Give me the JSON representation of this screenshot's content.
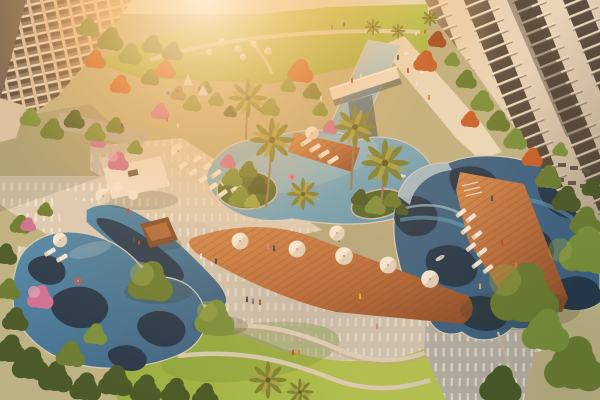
{
  "meta": {
    "title": "Resort-style residential courtyard — aerial render",
    "description": "Aerial architectural rendering at sunset: free-form lagoon pools with navy wave patterns, lap pool with white bridge, sun decks with white umbrellas and loungers, cabana, palm trees, lawns and apartment towers. Strong sun glare from the upper left."
  },
  "scene": {
    "lighting": "low warm sun, heavy glare upper-left, orange wash over scene",
    "buildings": {
      "left": "mid-rise apartment block with stacked white balconies",
      "right": "two high-rise towers, cream piers with dark glass and balcony slabs"
    },
    "water_features": [
      "lap pool with white bridge",
      "central lagoon pool with planted islands",
      "wave-pattern pool with in-water loungers",
      "free-form lagoon pool under trees"
    ],
    "amenities": [
      "dining deck with six white umbrellas",
      "white cabana",
      "brown pavilion",
      "lounger decks",
      "lawn terraces with curved curbs",
      "kids teepees and playground",
      "in-pool loungers"
    ],
    "vegetation": [
      "palm clusters",
      "autumn-orange trees",
      "pink bougainvillea",
      "tropical border planting",
      "large olive-green trees"
    ],
    "people": "about thirty small figures walking, dining, lounging and swimming"
  },
  "palette": {
    "glare_core": "#fff6e0",
    "glare_warm": "#ffd596",
    "warm_wash": "#ffb260",
    "lawn_light": "#b9cb55",
    "lawn_mid": "#8fb040",
    "lawn_dark": "#6d9634",
    "tree_dark": "#3c5526",
    "tree_olive": "#5f7a30",
    "tree_green": "#6f8f3a",
    "tree_light": "#96a848",
    "tree_autumn": "#c25a28",
    "tree_autumn_dark": "#9c4420",
    "tree_pink": "#cc6d9d",
    "tree_pink_light": "#e09cc0",
    "palm_frond": "#758032",
    "palm_frond_light": "#a3a348",
    "palm_trunk": "#9a7a52",
    "pool_pale": "#bcd8e4",
    "pool_light": "#7fb6d2",
    "pool_mid": "#4289b4",
    "pool_deep": "#2e5d87",
    "pool_navy": "#15304c",
    "pool_teal": "#57a0c0",
    "deck_wood": "#b5693c",
    "deck_wood_dark": "#8a4a28",
    "deck_warm": "#d08a50",
    "pave_light": "#d9d2c2",
    "pave_cool": "#b3b2ac",
    "pave_white": "#f3f0e8",
    "path_cream": "#e8dfc8",
    "bldg_wall": "#7b7066",
    "bldg_wall_dark": "#665c52",
    "bldg_cream": "#d6c7b2",
    "bldg_slab": "#eae3d5",
    "bldg_glass": "#46403a",
    "tower_cream": "#e7dbc6",
    "tower_glass": "#4a443f",
    "tower_slab": "#f0e6d4",
    "white": "#f5f0e4",
    "umbrella_shadow": "#d9d0bd",
    "cabana_white": "#efe9dd",
    "pavilion_brown": "#7c4a2b",
    "water_splash": "#eaf4f6",
    "shade": "#243418"
  }
}
